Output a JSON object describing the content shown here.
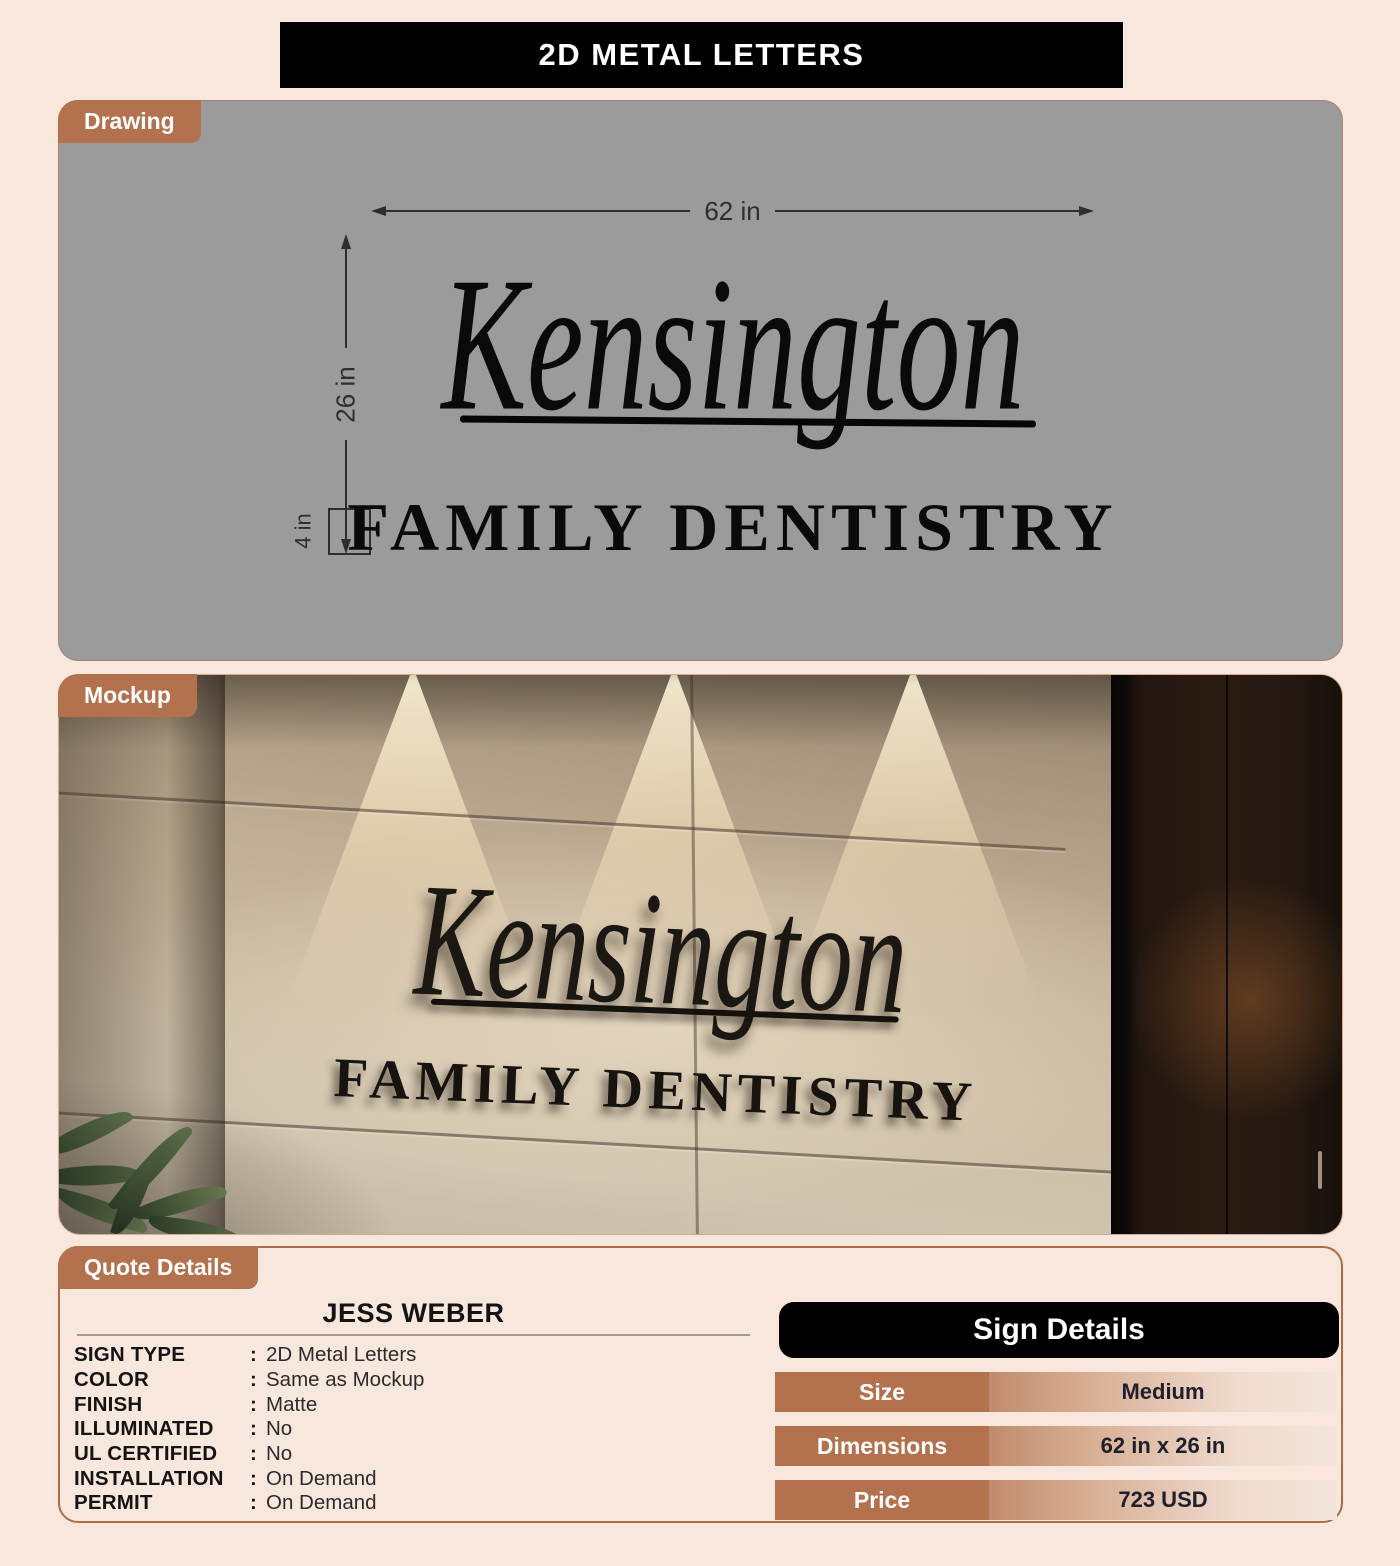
{
  "header": {
    "title": "2D METAL LETTERS"
  },
  "drawing": {
    "tab": "Drawing",
    "dim_width": "62 in",
    "dim_height": "26 in",
    "dim_letter_height": "4 in",
    "sign_line1": "Kensington",
    "sign_line2": "FAMILY DENTISTRY"
  },
  "mockup": {
    "tab": "Mockup",
    "sign_line1": "Kensington",
    "sign_line2": "FAMILY DENTISTRY"
  },
  "quote": {
    "tab": "Quote Details",
    "customer": "JESS WEBER",
    "fields": [
      {
        "label": "SIGN TYPE",
        "value": "2D Metal Letters"
      },
      {
        "label": "COLOR",
        "value": "Same as Mockup"
      },
      {
        "label": "FINISH",
        "value": "Matte"
      },
      {
        "label": "ILLUMINATED",
        "value": "No"
      },
      {
        "label": "UL CERTIFIED",
        "value": "No"
      },
      {
        "label": "INSTALLATION",
        "value": "On Demand"
      },
      {
        "label": "PERMIT",
        "value": "On Demand"
      }
    ]
  },
  "sign_details": {
    "title": "Sign Details",
    "rows": [
      {
        "label": "Size",
        "value": "Medium"
      },
      {
        "label": "Dimensions",
        "value": "62 in x 26 in"
      },
      {
        "label": "Price",
        "value": "723 USD"
      }
    ]
  },
  "colors": {
    "accent_brown": "#b3714d",
    "panel_gray": "#9b9b9b",
    "page_bg": "#f8e7dc",
    "header_bg": "#000000"
  }
}
